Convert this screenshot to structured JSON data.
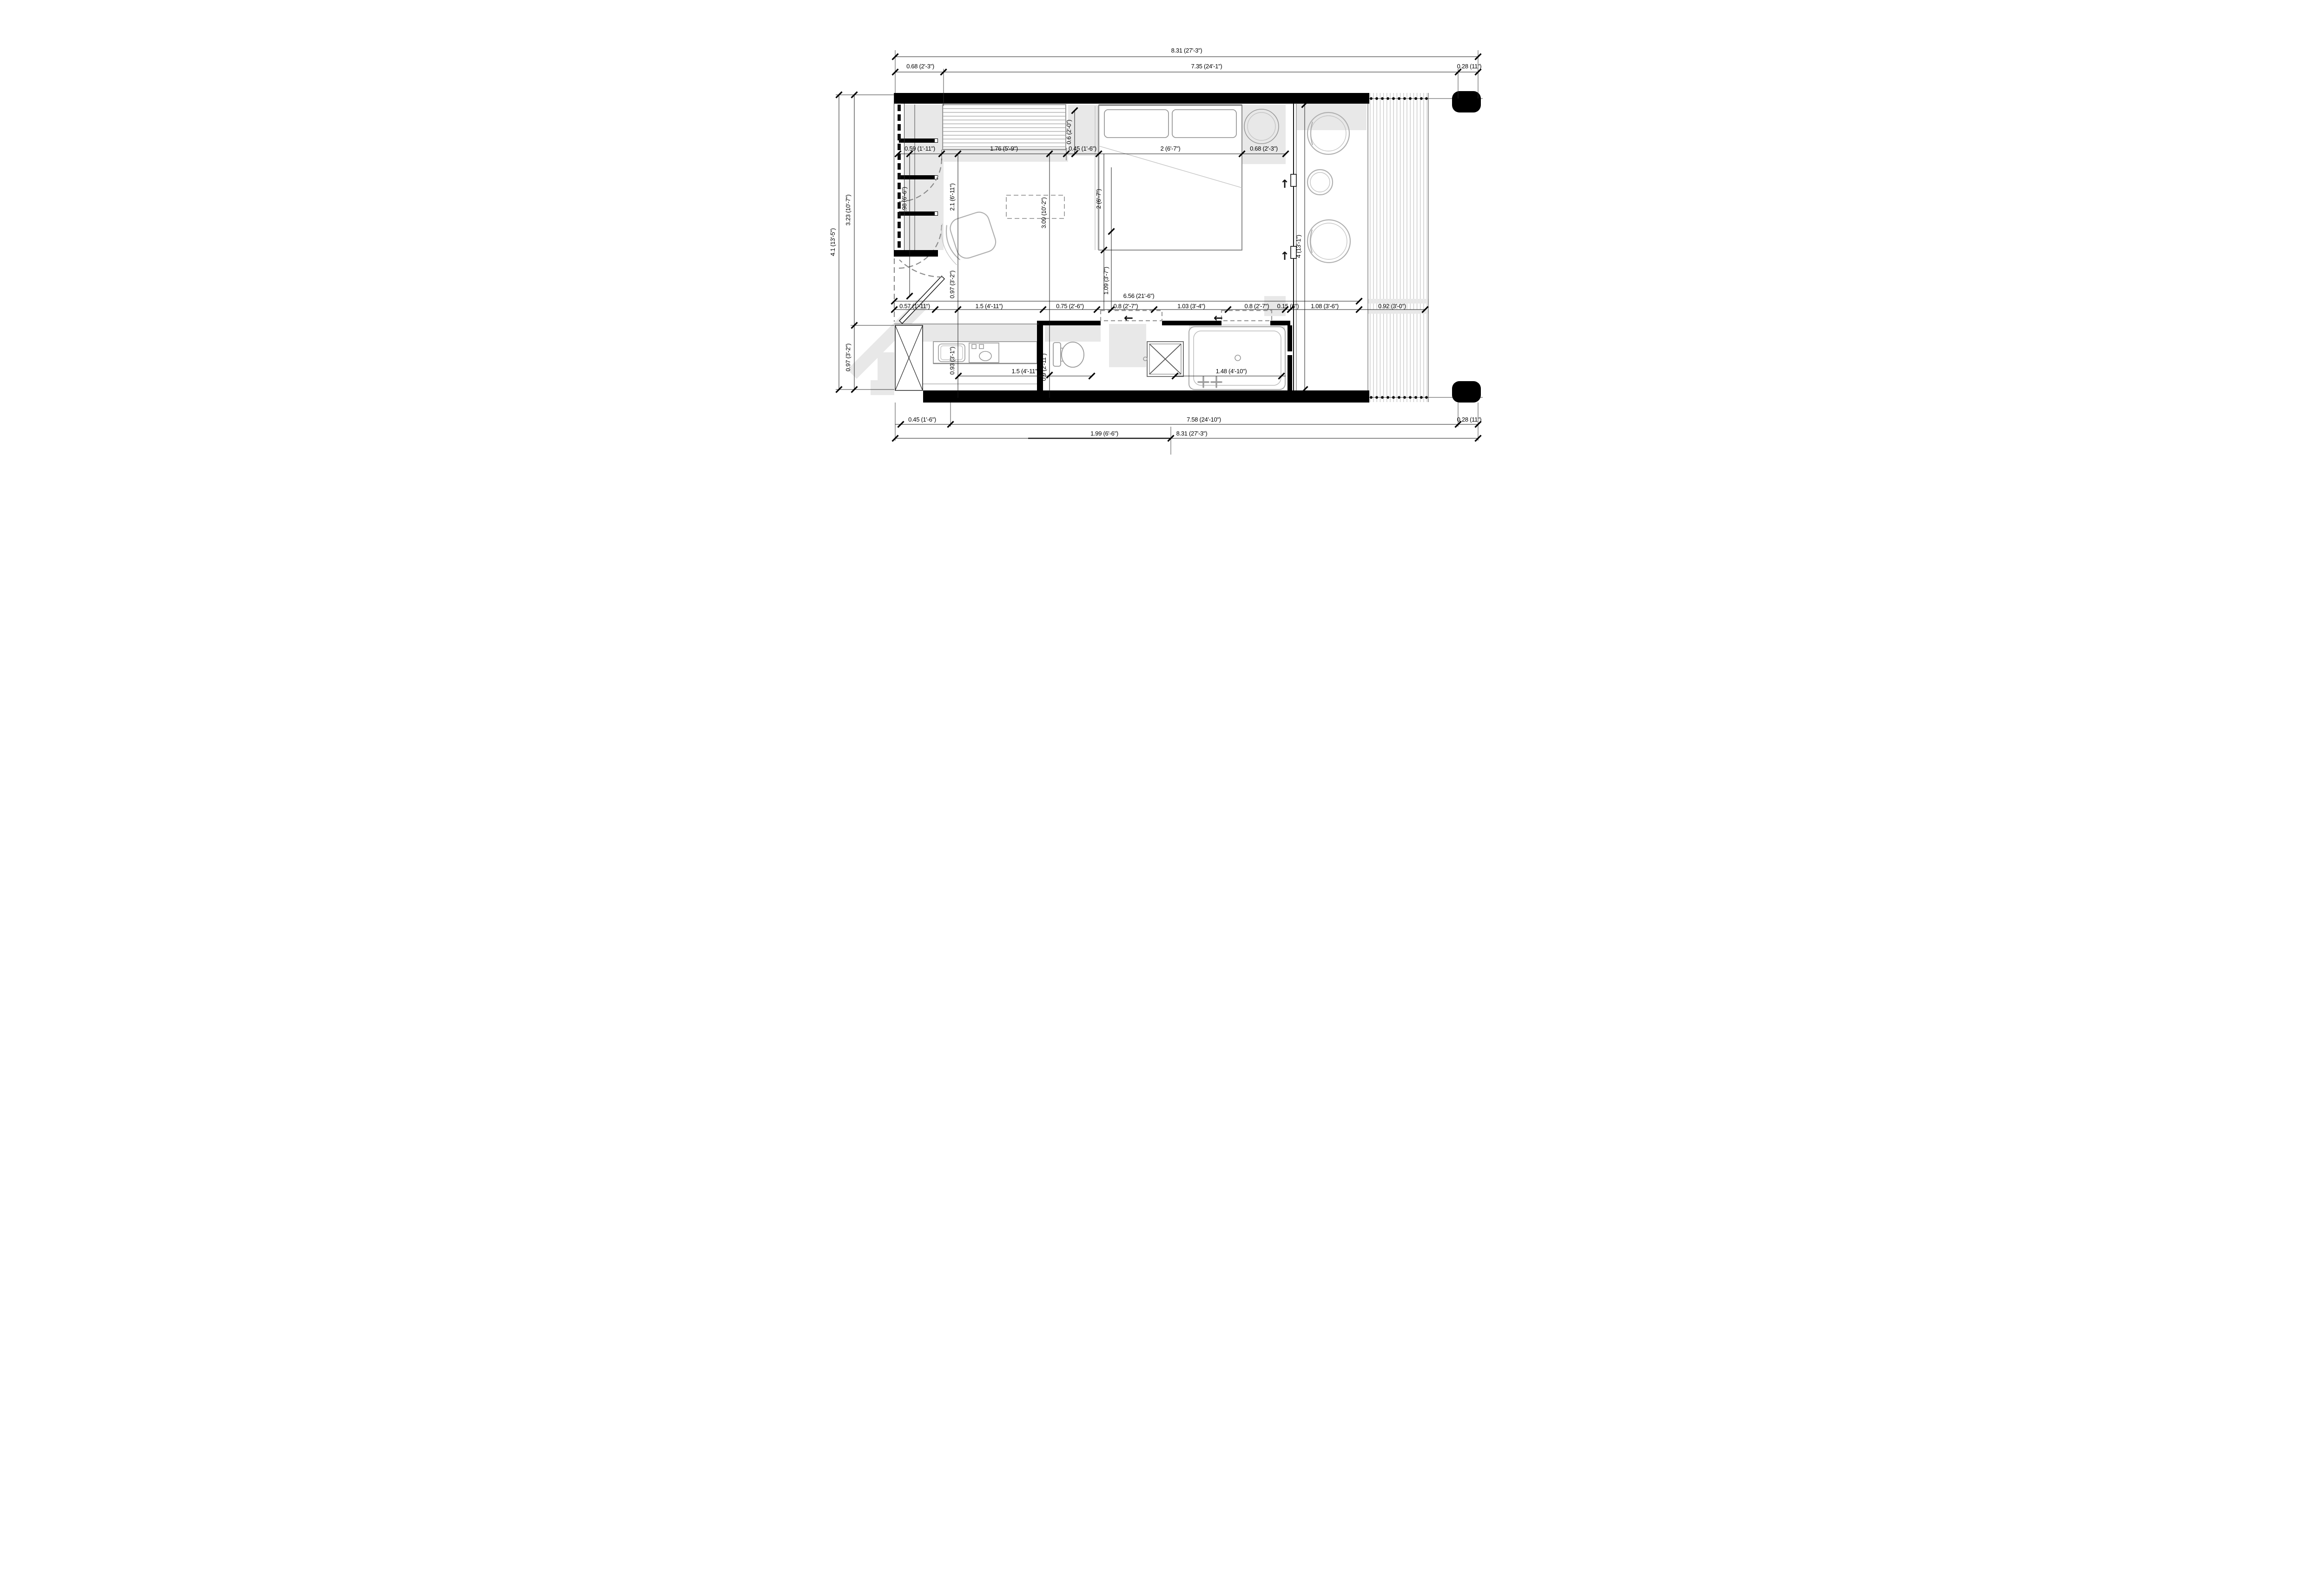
{
  "dims": {
    "top_total": "8.31 (27'-3\")",
    "top_left": "0.68 (2'-3\")",
    "top_mid": "7.35 (24'-1\")",
    "top_right": "0.28 (11\")",
    "left_total": "4.1 (13'-5\")",
    "left_upper": "3.23 (10'-7\")",
    "left_lower": "0.97 (3'-2\")",
    "row1": [
      "0.59 (1'-11\")",
      "1.76 (5'-9\")",
      "0.45 (1'-6\")",
      "2 (6'-7\")",
      "0.68 (2'-3\")"
    ],
    "v_head_gap": "0.6 (2'-0\")",
    "v_closet": "1.98 (6'-6\")",
    "v_closet_wall": "2.1 (6'-11\")",
    "v_living": "3.09 (10'-2\")",
    "v_bed": "2 (6'-7\")",
    "v_window": "4 (13'-1\")",
    "v_entry": "0.97 (3'-2\")",
    "v_hall": "1.09 (3'-7\")",
    "interior_width": "6.56 (21'-6\")",
    "row2": [
      "0.57 (1'-11\")",
      "1.5 (4'-11\")",
      "0.75 (2'-6\")",
      "0.8 (2'-7\")",
      "1.03 (3'-4\")",
      "0.8 (2'-7\")",
      "0.15 (6\")",
      "1.08 (3'-6\")",
      "0.92 (3'-0\")"
    ],
    "v_kitchen": "0.93 (3'-1\")",
    "kitchen_width": "1.5 (4'-11\")",
    "v_bath": "0.9 (2'-11\")",
    "tub_width": "1.48 (4'-10\")",
    "bottom_left": "0.45 (1'-6\")",
    "bottom_mid": "7.58 (24'-10\")",
    "bottom_right": "0.28 (11\")",
    "bottom_entry": "1.99 (6'-6\")",
    "bottom_total": "8.31 (27'-3\")"
  },
  "icons": {
    "slide_left": "←",
    "swing_up": "↑"
  },
  "colors": {
    "wall": "#000000",
    "shadow": "#e8e8e8",
    "furniture": "#b0b0b0",
    "dim_line": "#1a1a1a",
    "deck_stripe": "#c9c9c9"
  }
}
